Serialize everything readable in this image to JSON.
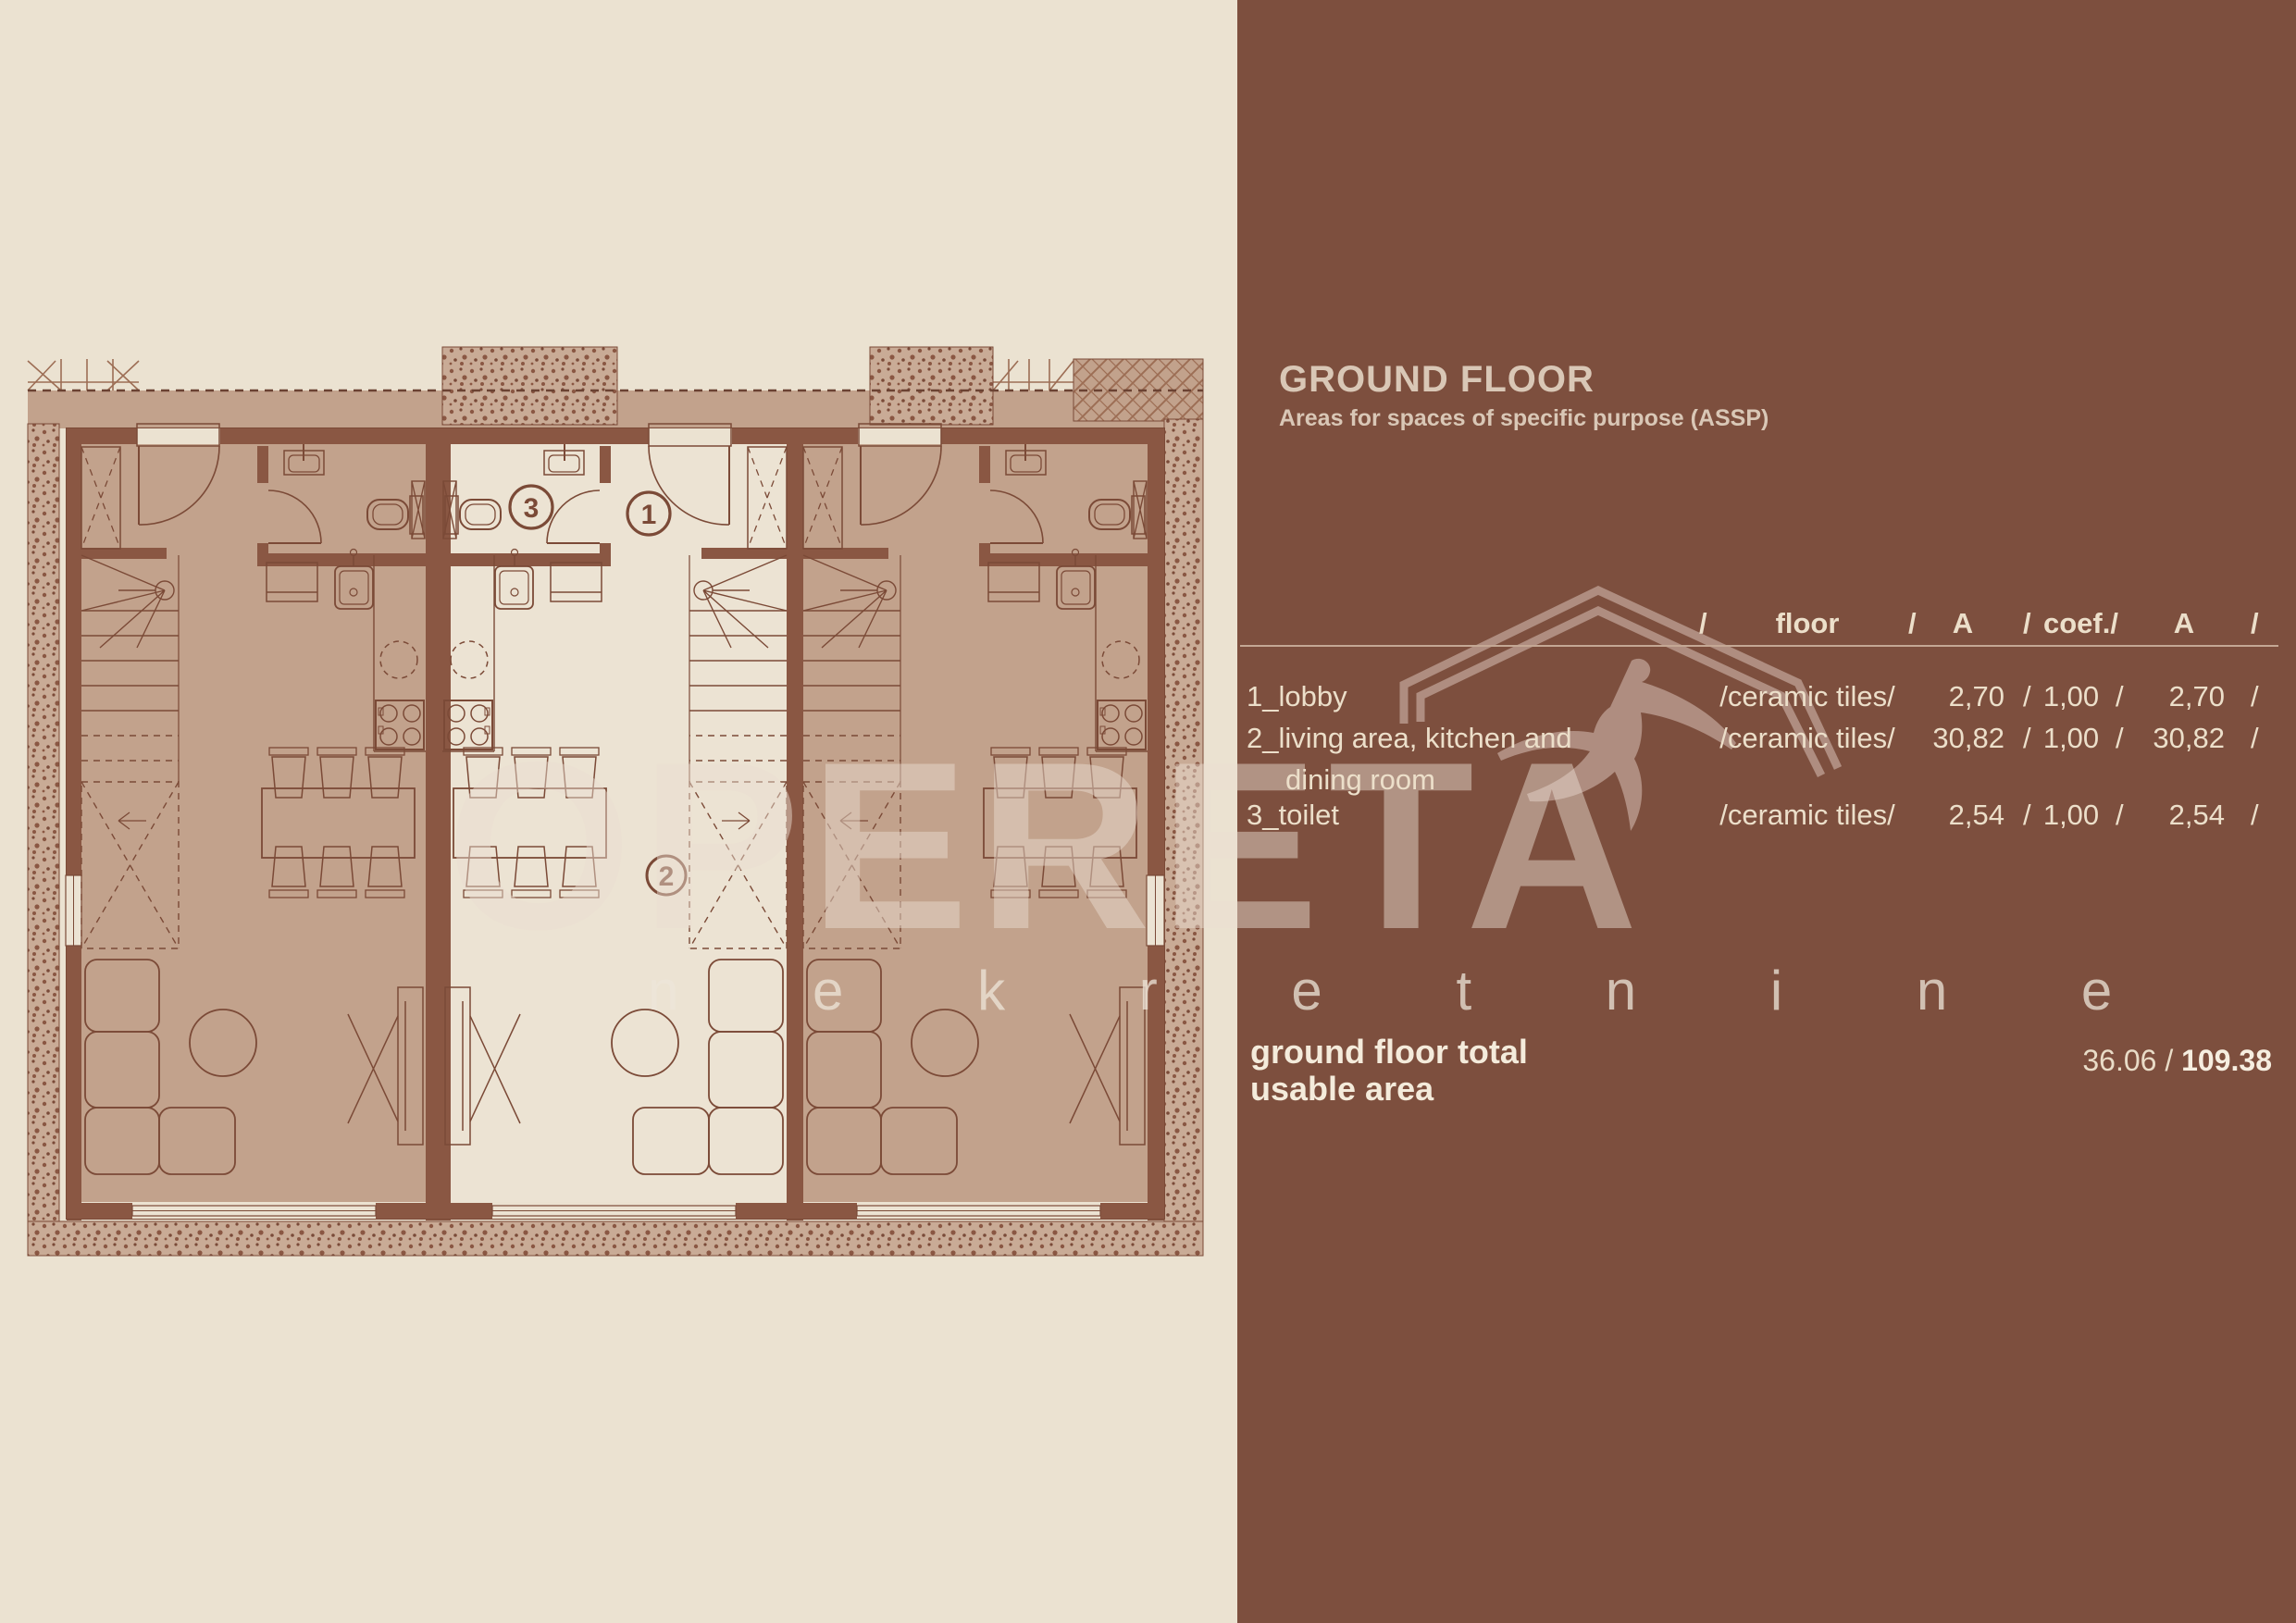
{
  "header": {
    "title": "GROUND FLOOR",
    "subtitle": "Areas for spaces of specific purpose (ASSP)"
  },
  "table": {
    "columns": {
      "slash": "/",
      "floor": "floor",
      "area": "A",
      "coef": "coef./",
      "area2": "A"
    },
    "rows": [
      {
        "name": "1_lobby",
        "name2": "",
        "floor": "/ceramic tiles/",
        "area": "2,70",
        "coef": "1,00",
        "area2": "2,70"
      },
      {
        "name": "2_living area, kitchen and",
        "name2": "dining room",
        "floor": "/ceramic tiles/",
        "area": "30,82",
        "coef": "1,00",
        "area2": "30,82"
      },
      {
        "name": "3_toilet",
        "name2": "",
        "floor": "/ceramic tiles/",
        "area": "2,54",
        "coef": "1,00",
        "area2": "2,54"
      }
    ]
  },
  "totals": {
    "line1": "ground floor total",
    "line2": "usable area",
    "value": "36.06 / ",
    "value_bold": "109.38"
  },
  "watermark": {
    "name": "OPERETA",
    "tagline": "n e k r e t n i n e"
  },
  "floor_plan": {
    "unit_labels": {
      "lobby": "1",
      "living": "2",
      "toilet": "3"
    }
  },
  "colors": {
    "background_cream": "#ebe2d1",
    "panel_brown": "#7d4f3e",
    "unit_tan": "#c2a28c",
    "wall_brown": "#8a5743",
    "line_brown": "#7b4a37",
    "text_cream": "#ecdfca",
    "muted_title": "#d9c7b6"
  }
}
